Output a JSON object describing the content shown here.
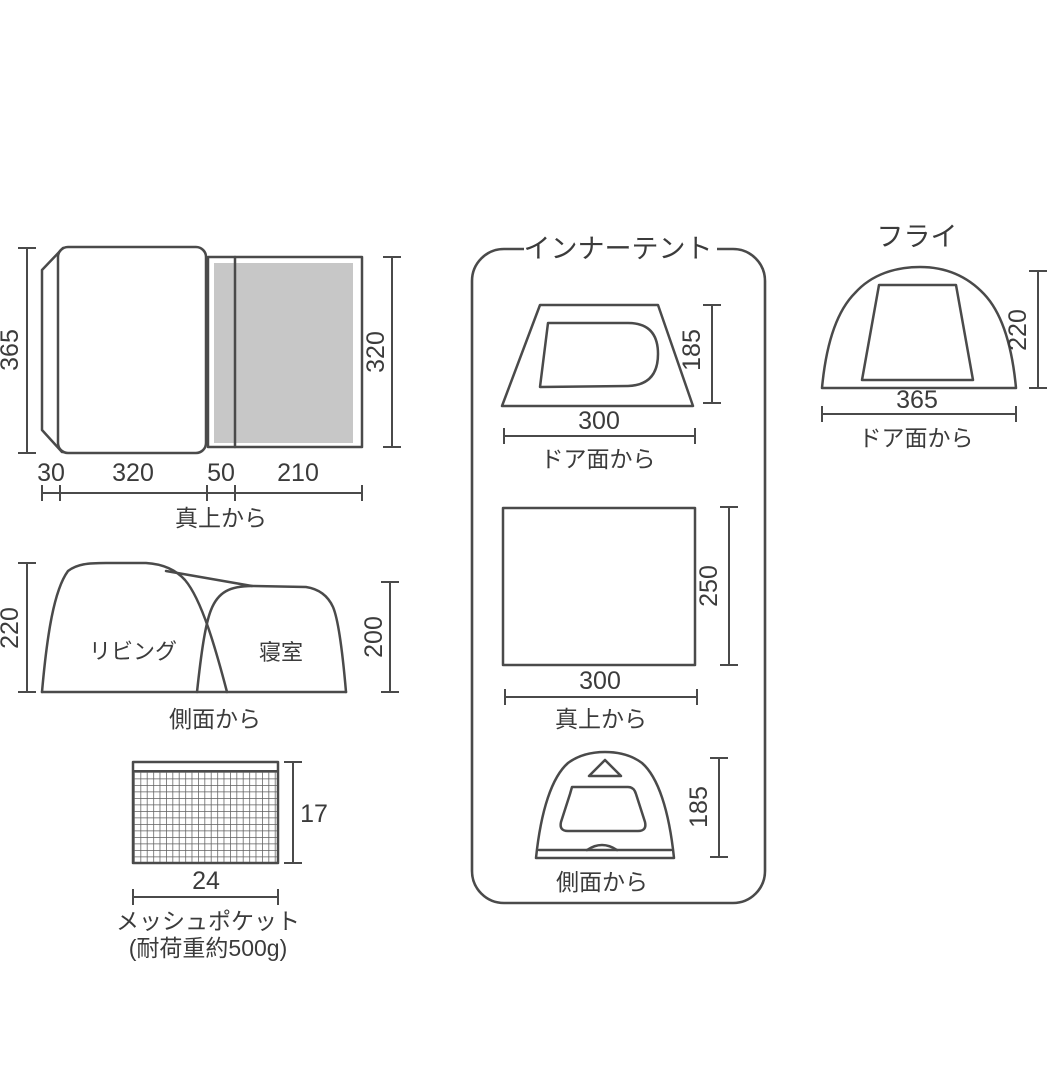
{
  "colors": {
    "line": "#4a4a4a",
    "text": "#3b3b3b",
    "gray_fill": "#c7c7c7",
    "mesh_line": "#5f5f5f"
  },
  "overall": {
    "top_view": {
      "caption": "真上から",
      "height_left": "365",
      "height_right": "320",
      "widths": [
        "30",
        "320",
        "50",
        "210"
      ]
    },
    "side_view": {
      "caption": "側面から",
      "room_left": "リビング",
      "room_right": "寝室",
      "height_left": "220",
      "height_right": "200"
    },
    "mesh_pocket": {
      "caption": "メッシュポケット",
      "note": "(耐荷重約500g)",
      "height": "17",
      "width": "24"
    }
  },
  "inner_tent": {
    "title": "インナーテント",
    "door_view": {
      "caption": "ドア面から",
      "width": "300",
      "height": "185"
    },
    "top_view": {
      "caption": "真上から",
      "width": "300",
      "height": "250"
    },
    "side_view": {
      "caption": "側面から",
      "height": "185"
    }
  },
  "fly": {
    "title": "フライ",
    "caption": "ドア面から",
    "width": "365",
    "height": "220"
  }
}
